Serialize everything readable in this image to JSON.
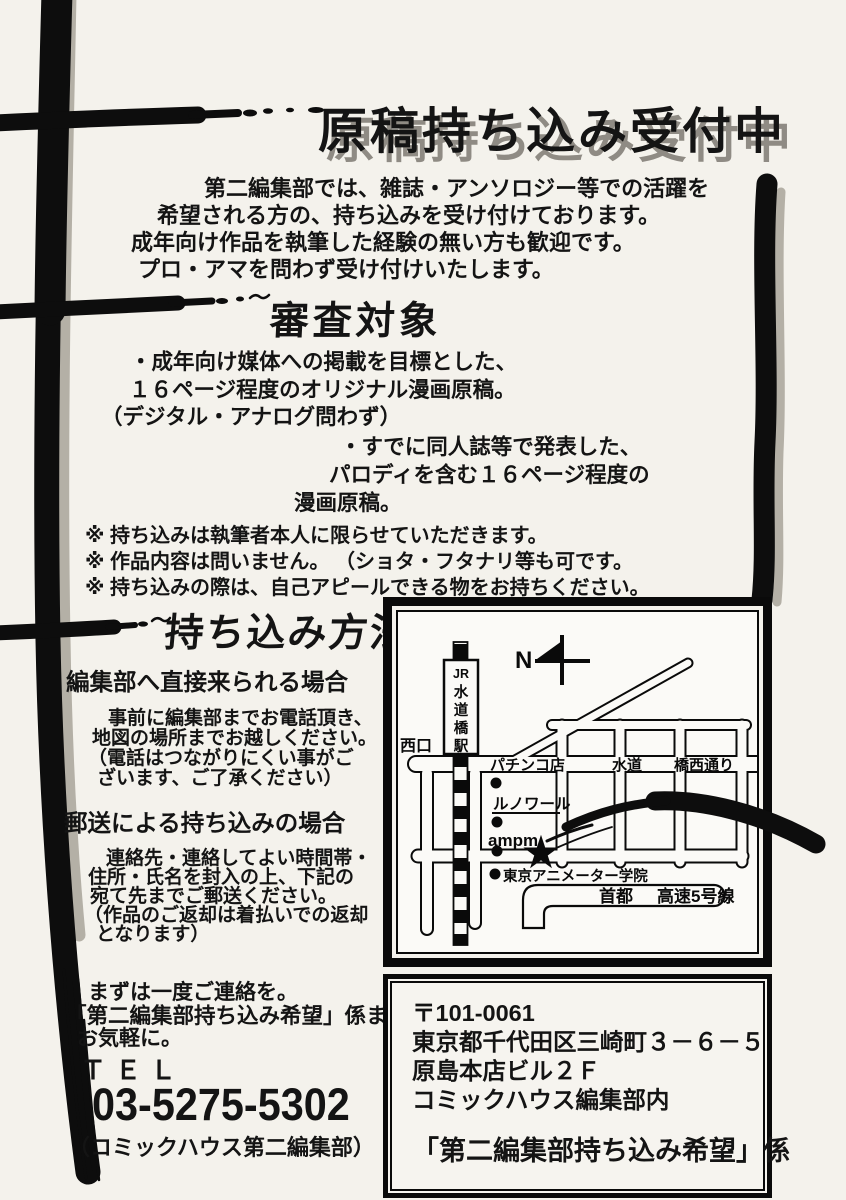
{
  "page": {
    "bg": "#f4f2ec",
    "ink": "#141414",
    "shadow_gray": "#8f8b84"
  },
  "title": {
    "text": "原稿持ち込み受付中"
  },
  "intro": {
    "lines": [
      "第二編集部では、雑誌・アンソロジー等での活躍を",
      "希望される方の、持ち込みを受け付けております。",
      "成年向け作品を執筆した経験の無い方も歓迎です。",
      "プロ・アマを問わず受け付けいたします。"
    ]
  },
  "review": {
    "heading": "審査対象",
    "bullet1": [
      "・成年向け媒体への掲載を目標とした、",
      "１６ページ程度のオリジナル漫画原稿。",
      "（デジタル・アナログ問わず）"
    ],
    "bullet2": [
      "・すでに同人誌等で発表した、",
      "パロディを含む１６ページ程度の",
      "漫画原稿。"
    ],
    "notes": [
      "※ 持ち込みは執筆者本人に限らせていただきます。",
      "※ 作品内容は問いません。 （ショタ・フタナリ等も可です。",
      "※ 持ち込みの際は、自己アピールできる物をお持ちください。"
    ]
  },
  "method": {
    "heading": "持ち込み方法",
    "visit": {
      "heading": "編集部へ直接来られる場合",
      "lines": [
        "事前に編集部までお電話頂き、",
        "地図の場所までお越しください。",
        "（電話はつながりにくい事がご",
        "ざいます、ご了承ください）"
      ]
    },
    "mail": {
      "heading": "郵送による持ち込みの場合",
      "lines": [
        "連絡先・連絡してよい時間帯・",
        "住所・氏名を封入の上、下記の",
        "宛て先までご郵送ください。",
        "（作品のご返却は着払いでの返却",
        "となります）"
      ]
    },
    "closing": [
      "まずは一度ご連絡を。",
      "「第二編集部持ち込み希望」係まで",
      "お気軽に。"
    ],
    "tel_label": "ＴＥＬ",
    "tel_number": "03-5275-5302",
    "tel_note": "（コミックハウス第二編集部）"
  },
  "map": {
    "north": "N",
    "station_parts": [
      "JR",
      "水",
      "道",
      "橋",
      "駅"
    ],
    "west_exit": "西口",
    "pachinko": "パチンコ店",
    "street_1": "水道",
    "street_2": "橋西通り",
    "renoir": "ルノワール",
    "ampm": "ampm",
    "school": "東京アニメーター学院",
    "expressway_1": "首都",
    "expressway_2": "高速5号線",
    "star": "★"
  },
  "address": {
    "lines": [
      "〒101-0061",
      "東京都千代田区三崎町３－６－５",
      "原島本店ビル２Ｆ",
      "コミックハウス編集部内"
    ],
    "recipient": "「第二編集部持ち込み希望」係"
  }
}
